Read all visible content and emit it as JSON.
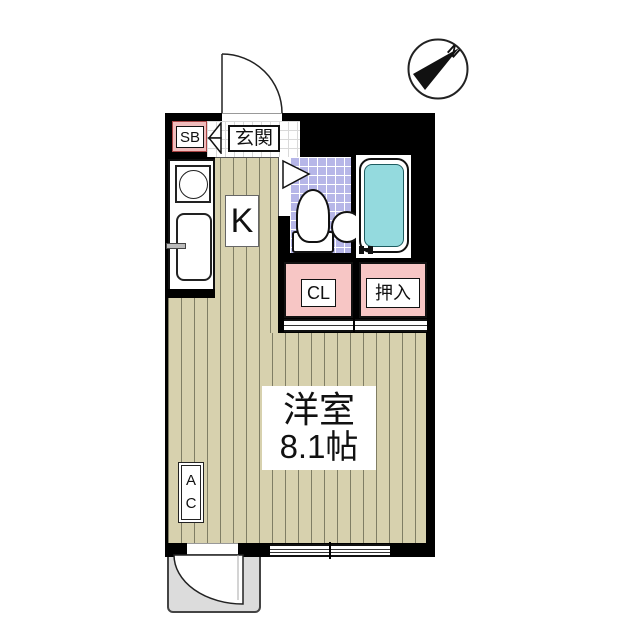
{
  "compass": {
    "north_label": "N"
  },
  "rooms": {
    "shoe_box": {
      "label": "SB"
    },
    "entrance": {
      "label": "玄関"
    },
    "kitchen": {
      "label": "K"
    },
    "closet": {
      "label": "CL"
    },
    "oshiire": {
      "label": "押入"
    },
    "main_room": {
      "name": "洋室",
      "size": "8.1帖"
    },
    "air_conditioner": {
      "label": "AC"
    }
  },
  "colors": {
    "wall": "#000000",
    "floor": "#d7d1ae",
    "floor_stripe": "#7f7d64",
    "bath_tile": "#b6b6e8",
    "bathtub_water": "#94dade",
    "closet_pink": "#f7c6c5",
    "shoe_box_pink": "#f0bcbc",
    "porch_gray": "#dcdcdc"
  }
}
